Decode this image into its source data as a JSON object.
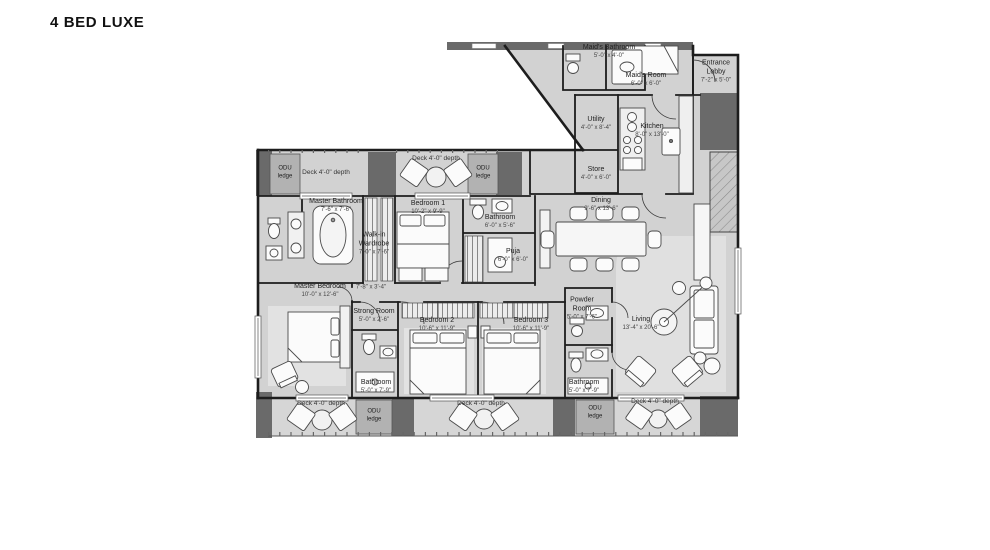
{
  "title": "4 BED LUXE",
  "colors": {
    "floor": "#d2d2d2",
    "wall": "#1d1d1d",
    "block": "#6a6a6a",
    "rug": "#e2e2e2"
  },
  "plan": {
    "rooms": [
      {
        "id": "maids-bathroom",
        "name": "Maid's Bathroom",
        "dims": "5'-0\" x 4'-0\""
      },
      {
        "id": "maids-room",
        "name": "Maid's Room",
        "dims": "6'-0\" x 6'-0\""
      },
      {
        "id": "entrance-lobby",
        "name": "Entrance Lobby",
        "dims": "7'-2\" x 5'-0\""
      },
      {
        "id": "utility",
        "name": "Utility",
        "dims": "4'-0\" x 8'-4\""
      },
      {
        "id": "kitchen",
        "name": "Kitchen",
        "dims": "8'-0\" x 13'-0\""
      },
      {
        "id": "store",
        "name": "Store",
        "dims": "4'-0\" x 6'-0\""
      },
      {
        "id": "dining",
        "name": "Dining",
        "dims": "9'-6\" x 13'-6\""
      },
      {
        "id": "master-bathroom",
        "name": "Master Bathroom",
        "dims": "7'-6\" x 7'-6\""
      },
      {
        "id": "walkin-wardrobe",
        "name": "Walk-in Wardrobe",
        "dims": "7'-0\" x 7'-6\""
      },
      {
        "id": "bedroom-1",
        "name": "Bedroom 1",
        "dims": "10'-2\" x 9'-9\""
      },
      {
        "id": "bathroom-1",
        "name": "Bathroom",
        "dims": "6'-0\" x 5'-6\""
      },
      {
        "id": "puja",
        "name": "Puja",
        "dims": "6'-0\" x 6'-0\""
      },
      {
        "id": "master-bedroom",
        "name": "Master Bedroom",
        "dims": "10'-0\" x 12'-6\""
      },
      {
        "id": "passage",
        "name": "",
        "dims": "7'-8\" x 3'-4\""
      },
      {
        "id": "strong-room",
        "name": "Strong Room",
        "dims": "5'-0\" x 2'-6\""
      },
      {
        "id": "bathroom-2",
        "name": "Bathroom",
        "dims": "5'-0\" x 7'-9\""
      },
      {
        "id": "bedroom-2",
        "name": "Bedroom 2",
        "dims": "10'-6\" x 11'-9\""
      },
      {
        "id": "bedroom-3",
        "name": "Bedroom 3",
        "dims": "10'-6\" x 11'-9\""
      },
      {
        "id": "powder-room",
        "name": "Powder Room",
        "dims": "5'-0\" x 7'-6\""
      },
      {
        "id": "bathroom-3",
        "name": "Bathroom",
        "dims": "5'-0\" x 7'-9\""
      },
      {
        "id": "living",
        "name": "Living",
        "dims": "13'-4\" x 20'-6\""
      }
    ],
    "decks": [
      {
        "id": "1",
        "label": "Deck 4'-0\" depth"
      },
      {
        "id": "2",
        "label": "Deck 4'-0\" depth"
      },
      {
        "id": "3",
        "label": "Deck 4'-0\" depth"
      },
      {
        "id": "4",
        "label": "Deck 4'-0\" depth"
      },
      {
        "id": "5",
        "label": "Deck 4'-0\" depth"
      }
    ],
    "odu_ledges": [
      {
        "id": "1",
        "label": "ODU ledge"
      },
      {
        "id": "2",
        "label": "ODU ledge"
      },
      {
        "id": "3",
        "label": "ODU ledge"
      },
      {
        "id": "4",
        "label": "ODU ledge"
      }
    ]
  }
}
